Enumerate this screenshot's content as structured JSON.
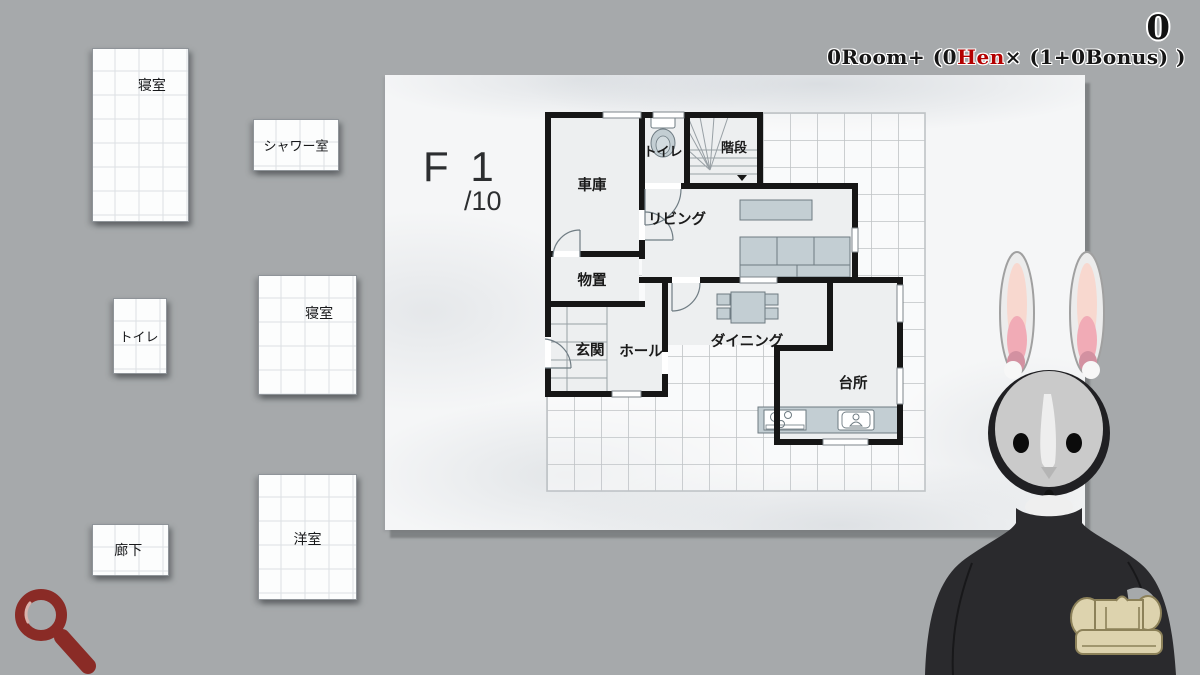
{
  "hud": {
    "score_value": "0",
    "formula": {
      "part1": "0Room+ (0",
      "red": "Hen",
      "part2": "× (1+0Bonus) )"
    }
  },
  "board": {
    "floor_label": "F 1",
    "floor_progress": "/10",
    "room_labels": {
      "toilet": "トイレ",
      "stairs": "階段",
      "garage": "車庫",
      "living": "リビング",
      "storage": "物置",
      "entrance": "玄関",
      "hall": "ホール",
      "dining": "ダイニング",
      "kitchen": "台所"
    }
  },
  "tray": {
    "cards": [
      {
        "id": "bedroom-1",
        "label": "寝室"
      },
      {
        "id": "shower",
        "label": "シャワー室"
      },
      {
        "id": "toilet",
        "label": "トイレ"
      },
      {
        "id": "bedroom-2",
        "label": "寝室"
      },
      {
        "id": "corridor",
        "label": "廊下"
      },
      {
        "id": "western-room",
        "label": "洋室"
      }
    ]
  },
  "character": {
    "type": "rabbit",
    "held_item": "sofa"
  },
  "colors": {
    "formula_red": "#b30000",
    "magnifier_red": "#8a2b26",
    "wall_black": "#161616"
  }
}
